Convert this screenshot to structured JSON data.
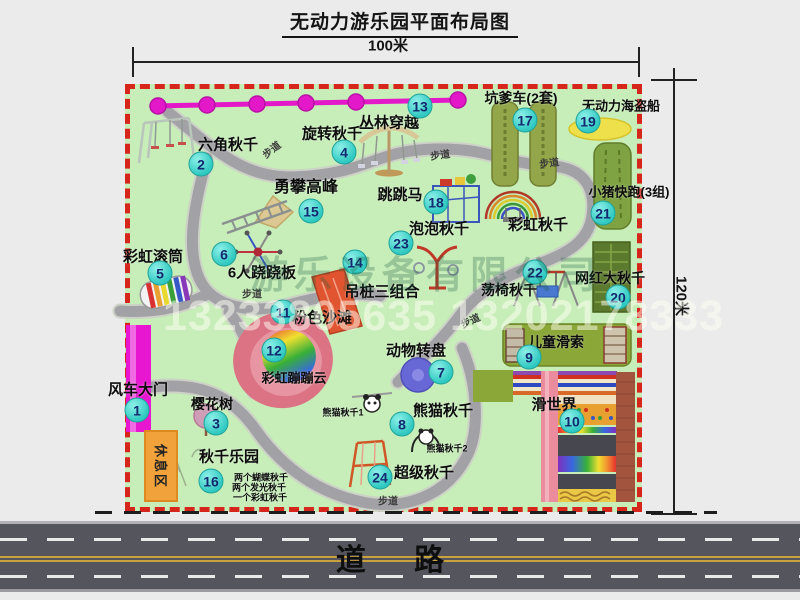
{
  "title": "无动力游乐园平面布局图",
  "dimensions": {
    "width": "100米",
    "height": "120米"
  },
  "road": {
    "label": "道 路"
  },
  "watermark": {
    "company": "游乐设备有限公司",
    "phones": "13233805635 13202178333"
  },
  "park": {
    "rest_area": "休息区",
    "walkway_label": "步道",
    "rainbow_swing_label": "彩虹秋千",
    "attractions": [
      {
        "num": "1",
        "name": "风车大门"
      },
      {
        "num": "2",
        "name": "六角秋千"
      },
      {
        "num": "3",
        "name": "樱花树"
      },
      {
        "num": "4",
        "name": "旋转秋千"
      },
      {
        "num": "5",
        "name": "彩虹滚筒"
      },
      {
        "num": "6",
        "name": "6人跷跷板"
      },
      {
        "num": "7",
        "name": "动物转盘"
      },
      {
        "num": "8",
        "name": "熊猫秋千"
      },
      {
        "num": "9",
        "name": "儿童滑索"
      },
      {
        "num": "10",
        "name": "滑世界"
      },
      {
        "num": "11",
        "name": "粉色沙滩"
      },
      {
        "num": "12",
        "name": "彩虹蹦蹦云"
      },
      {
        "num": "13",
        "name": "丛林穿越"
      },
      {
        "num": "14",
        "name": "吊桩三组合"
      },
      {
        "num": "15",
        "name": "勇攀高峰"
      },
      {
        "num": "16",
        "name": "秋千乐园"
      },
      {
        "num": "17",
        "name": "坑爹车(2套)"
      },
      {
        "num": "18",
        "name": "跳跳马"
      },
      {
        "num": "19",
        "name": "无动力海盗船"
      },
      {
        "num": "20",
        "name": "网红大秋千"
      },
      {
        "num": "21",
        "name": "小猪快跑(3组)"
      },
      {
        "num": "22",
        "name": "荡椅秋千"
      },
      {
        "num": "23",
        "name": "泡泡秋千"
      },
      {
        "num": "24",
        "name": "超级秋千"
      }
    ],
    "sub_labels": {
      "panda1": "熊猫秋千1",
      "panda2": "熊猫秋千2",
      "swing_park_items": [
        "两个蝴蝶秋千",
        "两个发光秋千",
        "一个彩虹秋千"
      ]
    }
  },
  "colors": {
    "park_green": "#c7edb9",
    "border_red": "#d6261c",
    "badge_cyan": "#2fc9c1",
    "gate_magenta": "#e816d0",
    "rest_orange": "#f2a23b",
    "road_gray": "#55555d"
  }
}
